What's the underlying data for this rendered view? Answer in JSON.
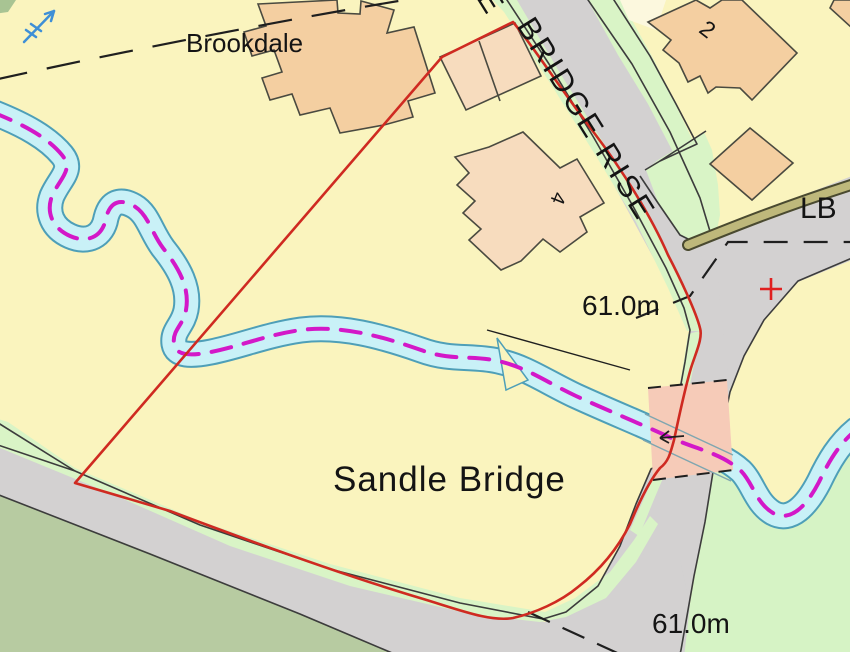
{
  "map": {
    "labels": {
      "estate_name": "Brookdale",
      "road_name": "BRIDGE RISE",
      "road_name_clipped": "E",
      "house_number_2": "2",
      "house_number_4": "4",
      "letter_box": "LB",
      "spot_height_mid": "61.0m",
      "place_name": "Sandle Bridge",
      "spot_height_bottom": "61.0m"
    },
    "icons": {
      "blue_flow_arrow": "stream-flow-direction-arrow",
      "bridge_flow_arrow": "stream-flow-direction-arrow",
      "junction_cross": "red-cross-marker"
    },
    "colors": {
      "parcel_yellow": "#FAF4BE",
      "cream_patch": "#FCF8DE",
      "building_peach": "#F4CFA1",
      "building_peach_light": "#F7DCBE",
      "road_gray": "#D3D1D1",
      "road_edge": "#3C3C3C",
      "verge_green": "#D9F4C6",
      "field_sage": "#B7CBA1",
      "field_light_green": "#D6F3C5",
      "stream_fill": "#C9F1F7",
      "stream_bank": "#4E9FB8",
      "stream_center_magenta": "#D318C8",
      "boundary_red": "#CF2A21",
      "path_olive": "#BEB87B",
      "path_olive_edge": "#4A4A30",
      "bridge_pink": "#F6CBB8",
      "marker_red": "#E02020",
      "arrow_blue": "#3E8FD6",
      "dash_black": "#1F1F1F",
      "corner_green": "#A8C493",
      "text_dark": "#141414"
    }
  }
}
